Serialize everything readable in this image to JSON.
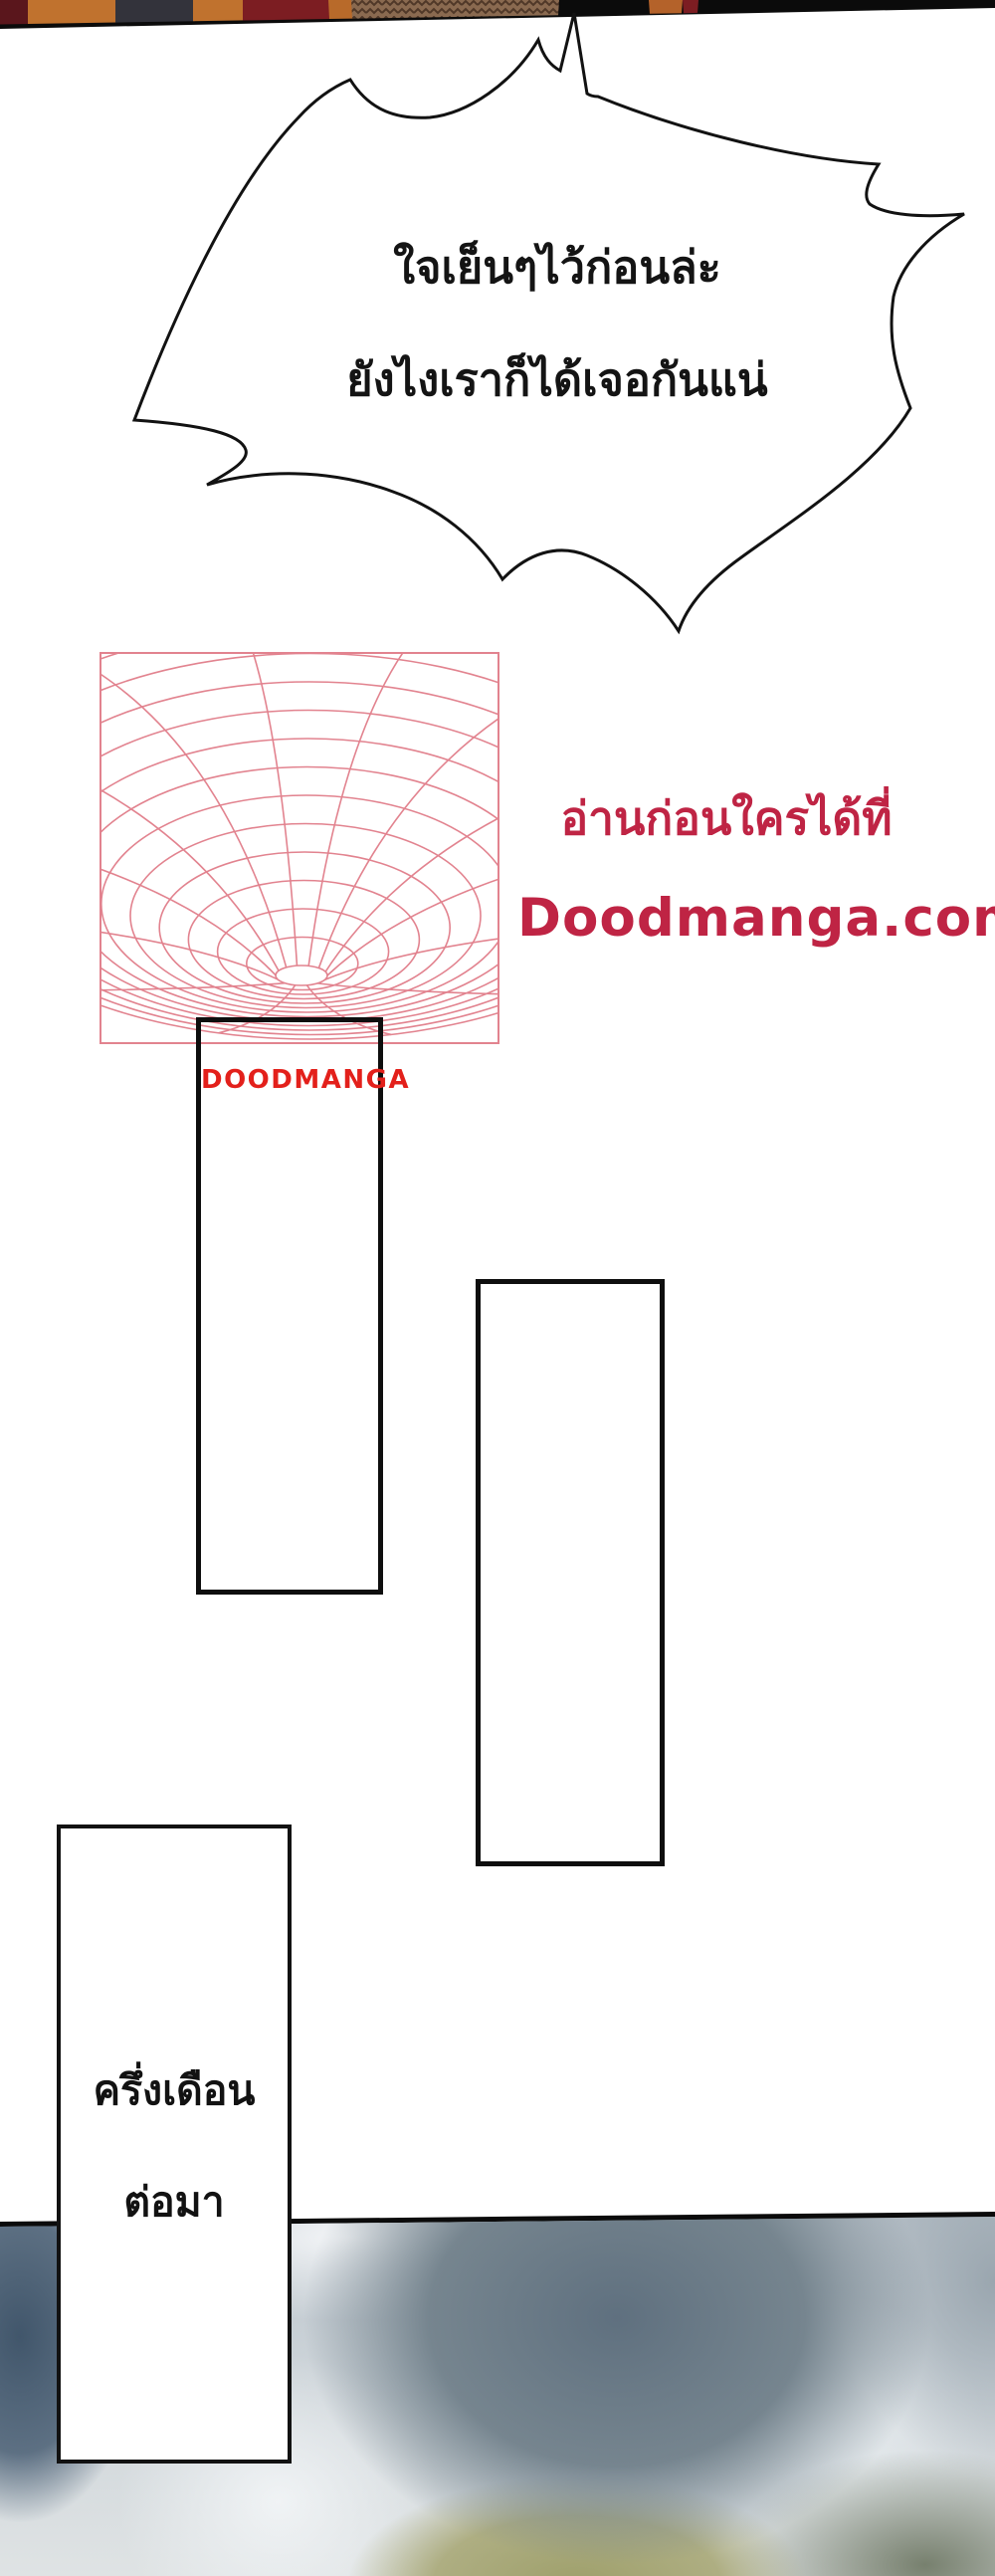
{
  "speech_bubble": {
    "line1": "ใจเย็นๆไว้ก่อนล่ะ",
    "line2": "ยังไงเราก็ได้เจอกันแน่"
  },
  "promo": {
    "line1": "อ่านก่อนใครได้ที่",
    "line2": "Doodmanga.com",
    "color": "#bf2444"
  },
  "watermark": {
    "label": "DOODMANGA",
    "color": "#e3201b"
  },
  "caption_box": {
    "line1": "ครึ่งเดือน",
    "line2": "ต่อมา"
  },
  "artwork": {
    "funnel_color": "#e2838f",
    "panel_border_color": "#0e0e0e"
  }
}
